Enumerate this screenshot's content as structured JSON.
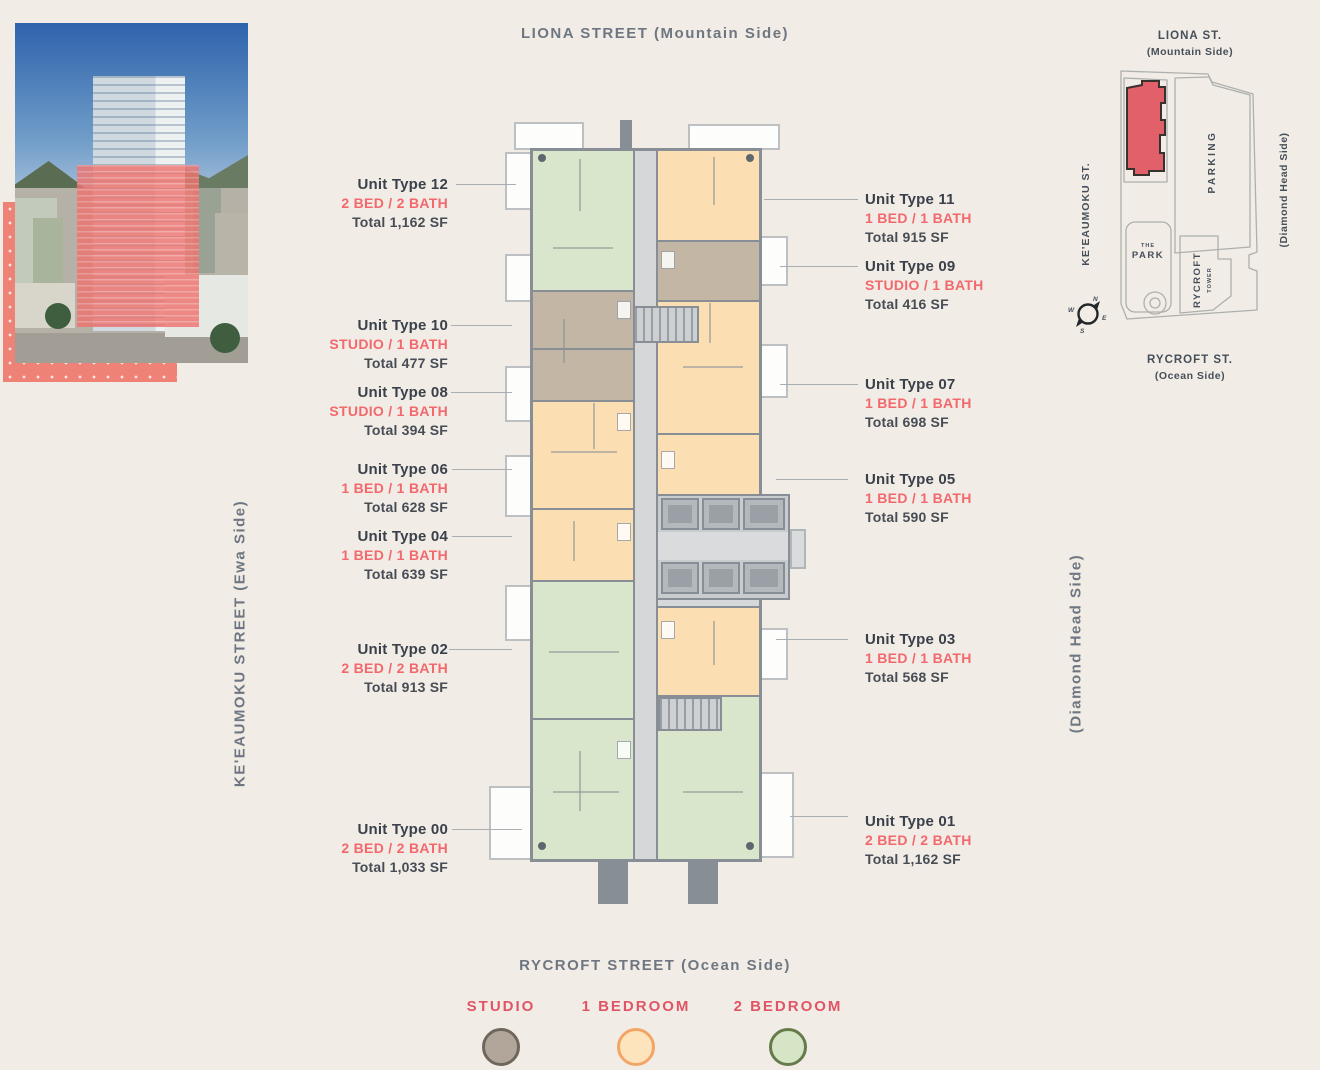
{
  "streets": {
    "top": "LIONA STREET (Mountain Side)",
    "bottom": "RYCROFT STREET (Ocean Side)",
    "left": "KE'EAUMOKU STREET (Ewa Side)",
    "right": "(Diamond Head Side)"
  },
  "units_left": [
    {
      "name": "Unit Type 12",
      "config": "2 BED / 2 BATH",
      "area": "Total 1,162 SF"
    },
    {
      "name": "Unit Type 10",
      "config": "STUDIO / 1 BATH",
      "area": "Total 477 SF"
    },
    {
      "name": "Unit Type 08",
      "config": "STUDIO / 1 BATH",
      "area": "Total 394 SF"
    },
    {
      "name": "Unit Type 06",
      "config": "1 BED / 1 BATH",
      "area": "Total 628 SF"
    },
    {
      "name": "Unit Type 04",
      "config": "1 BED / 1 BATH",
      "area": "Total 639 SF"
    },
    {
      "name": "Unit Type 02",
      "config": "2 BED / 2 BATH",
      "area": "Total 913 SF"
    },
    {
      "name": "Unit Type 00",
      "config": "2 BED / 2 BATH",
      "area": "Total 1,033 SF"
    }
  ],
  "units_right": [
    {
      "name": "Unit Type 11",
      "config": "1 BED / 1 BATH",
      "area": "Total 915 SF"
    },
    {
      "name": "Unit Type 09",
      "config": "STUDIO / 1 BATH",
      "area": "Total 416 SF"
    },
    {
      "name": "Unit Type 07",
      "config": "1 BED / 1 BATH",
      "area": "Total 698 SF"
    },
    {
      "name": "Unit Type 05",
      "config": "1 BED / 1 BATH",
      "area": "Total 590 SF"
    },
    {
      "name": "Unit Type 03",
      "config": "1 BED / 1 BATH",
      "area": "Total 568 SF"
    },
    {
      "name": "Unit Type 01",
      "config": "2 BED / 2 BATH",
      "area": "Total 1,162 SF"
    }
  ],
  "legend": [
    {
      "label": "STUDIO",
      "fill": "#b1a699",
      "stroke": "#6f675c"
    },
    {
      "label": "1 BEDROOM",
      "fill": "#fde4bd",
      "stroke": "#f3a566"
    },
    {
      "label": "2 BEDROOM",
      "fill": "#d6e5c6",
      "stroke": "#647c4a"
    }
  ],
  "sitemap": {
    "top_street": "LIONA ST.",
    "top_side": "(Mountain Side)",
    "left_street": "KE'EAUMOKU ST.",
    "right_side": "(Diamond Head Side)",
    "bottom_street": "RYCROFT ST.",
    "bottom_side": "(Ocean Side)",
    "parking": "PARKING",
    "park_line1": "THE",
    "park_line2": "PARK",
    "tower_line1": "RYCROFT",
    "tower_line2": "TOWER",
    "compass_n": "N",
    "compass_e": "E",
    "compass_s": "S",
    "compass_w": "W",
    "building_color": "#e2606a"
  },
  "colors": {
    "page_bg": "#f2ece6",
    "accent_red": "#f2686c",
    "legend_red": "#e05565",
    "dark_text": "#3a414a",
    "street_gray": "#6e7781",
    "plan_wall": "#878e95",
    "unit_studio": "#c4b6a5",
    "unit_1bed": "#fbdfb3",
    "unit_2bed": "#dae6cc",
    "corridor": "#d5d7d8",
    "photo_highlight": "#ef7470",
    "dots_panel": "#ee8276"
  }
}
